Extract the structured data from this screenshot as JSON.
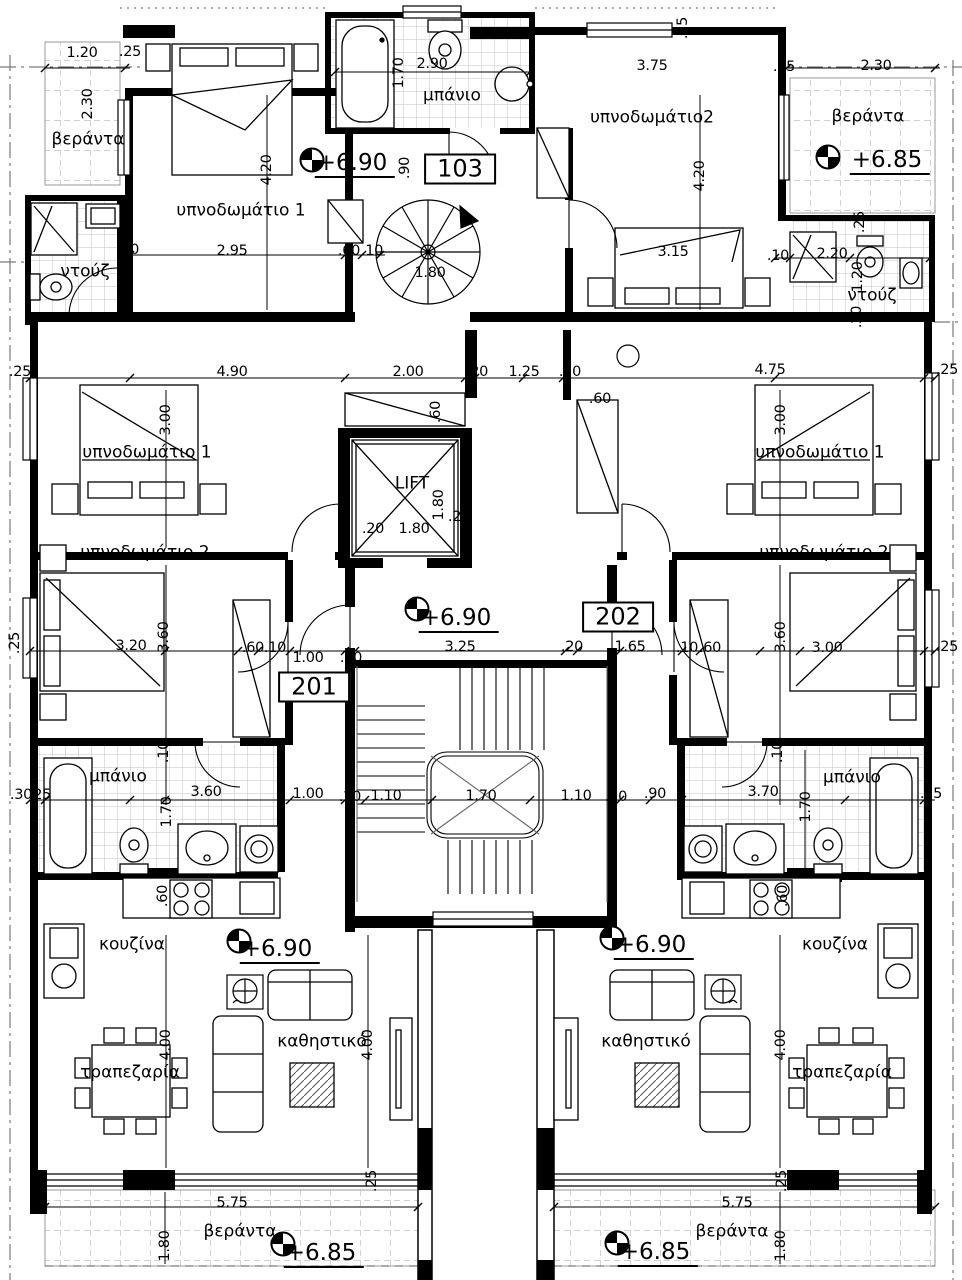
{
  "drawing": {
    "type": "architectural-floor-plan",
    "floor_levels_shown": [
      "+6.90",
      "+6.85"
    ],
    "unit_numbers_shown": [
      "103",
      "201",
      "202"
    ],
    "line_color": "#000000",
    "tile_color": "#bdbdbd"
  },
  "rooms": [
    {
      "id": "veranda-top-left",
      "text": "βεράντα",
      "x": 88,
      "y": 140
    },
    {
      "id": "bedroom1-103",
      "text": "υπνοδωμάτιο 1",
      "x": 241,
      "y": 211
    },
    {
      "id": "bath-103",
      "text": "μπάνιο",
      "x": 452,
      "y": 96
    },
    {
      "id": "bedroom2-103",
      "text": "υπνοδωμάτιο2",
      "x": 652,
      "y": 118
    },
    {
      "id": "veranda-top-right",
      "text": "βεράντα",
      "x": 868,
      "y": 117
    },
    {
      "id": "shower-left",
      "text": "ντούζ",
      "x": 85,
      "y": 272
    },
    {
      "id": "shower-right",
      "text": "ντούζ",
      "x": 872,
      "y": 296
    },
    {
      "id": "lift",
      "text": "LIFT",
      "x": 412,
      "y": 484
    },
    {
      "id": "bedroom1-201",
      "text": "υπνοδωμάτιο 1",
      "x": 147,
      "y": 453
    },
    {
      "id": "bedroom1-202",
      "text": "υπνοδωμάτιο 1",
      "x": 820,
      "y": 453
    },
    {
      "id": "bedroom2-201",
      "text": "υπνοδωμάτιο 2",
      "x": 145,
      "y": 553
    },
    {
      "id": "bedroom2-202",
      "text": "υπνοδωμάτιο 2",
      "x": 824,
      "y": 553
    },
    {
      "id": "bath-201",
      "text": "μπάνιο",
      "x": 118,
      "y": 777
    },
    {
      "id": "bath-202",
      "text": "μπάνιο",
      "x": 852,
      "y": 778
    },
    {
      "id": "kitchen-201",
      "text": "κουζίνα",
      "x": 132,
      "y": 945
    },
    {
      "id": "kitchen-202",
      "text": "κουζίνα",
      "x": 835,
      "y": 945
    },
    {
      "id": "living-201",
      "text": "καθηστικό",
      "x": 322,
      "y": 1042
    },
    {
      "id": "living-202",
      "text": "καθηστικό",
      "x": 646,
      "y": 1042
    },
    {
      "id": "dining-201",
      "text": "τραπεζαρία",
      "x": 130,
      "y": 1073
    },
    {
      "id": "dining-202",
      "text": "τραπεζαρία",
      "x": 842,
      "y": 1073
    },
    {
      "id": "veranda-bottom-left",
      "text": "βεράντα",
      "x": 240,
      "y": 1232
    },
    {
      "id": "veranda-bottom-right",
      "text": "βεράντα",
      "x": 732,
      "y": 1232
    }
  ],
  "unit_labels": [
    {
      "id": "103",
      "text": "103",
      "x": 460,
      "y": 169
    },
    {
      "id": "201",
      "text": "201",
      "x": 314,
      "y": 687
    },
    {
      "id": "202",
      "text": "202",
      "x": 618,
      "y": 617
    }
  ],
  "levels": [
    {
      "text": "+6.90",
      "x": 355,
      "y": 165,
      "mx": 312,
      "my": 160
    },
    {
      "text": "+6.85",
      "x": 890,
      "y": 162,
      "mx": 828,
      "my": 157
    },
    {
      "text": "+6.90",
      "x": 459,
      "y": 620,
      "mx": 417,
      "my": 609
    },
    {
      "text": "+6.90",
      "x": 280,
      "y": 951,
      "mx": 239,
      "my": 941
    },
    {
      "text": "+6.90",
      "x": 654,
      "y": 947,
      "mx": 612,
      "my": 938
    },
    {
      "text": "+6.85",
      "x": 324,
      "y": 1255,
      "mx": 283,
      "my": 1244
    },
    {
      "text": "+6.85",
      "x": 658,
      "y": 1254,
      "mx": 617,
      "my": 1243
    }
  ],
  "dimensions": [
    {
      "t": "1.20",
      "x": 82,
      "y": 53
    },
    {
      "t": ".25",
      "x": 130,
      "y": 52
    },
    {
      "t": "2.90",
      "x": 432,
      "y": 64
    },
    {
      "t": "3.75",
      "x": 652,
      "y": 66
    },
    {
      "t": ".25",
      "x": 683,
      "y": 28,
      "r": 1
    },
    {
      "t": "2.30",
      "x": 876,
      "y": 66
    },
    {
      "t": ".25",
      "x": 784,
      "y": 67
    },
    {
      "t": "2.30",
      "x": 88,
      "y": 104,
      "r": 1
    },
    {
      "t": "1.70",
      "x": 399,
      "y": 73,
      "r": 1
    },
    {
      "t": "4.20",
      "x": 267,
      "y": 170,
      "r": 1
    },
    {
      "t": ".90",
      "x": 405,
      "y": 168,
      "r": 1
    },
    {
      "t": "2.95",
      "x": 232,
      "y": 251
    },
    {
      "t": ".60",
      "x": 349,
      "y": 251
    },
    {
      "t": ".10",
      "x": 372,
      "y": 251
    },
    {
      "t": ".20",
      "x": 128,
      "y": 250
    },
    {
      "t": "1.80",
      "x": 430,
      "y": 273
    },
    {
      "t": "4.20",
      "x": 700,
      "y": 176,
      "r": 1
    },
    {
      "t": "3.15",
      "x": 673,
      "y": 252
    },
    {
      "t": ".10",
      "x": 778,
      "y": 256
    },
    {
      "t": "2.20",
      "x": 832,
      "y": 254
    },
    {
      "t": ".25",
      "x": 860,
      "y": 222,
      "r": 1
    },
    {
      "t": "1.20",
      "x": 858,
      "y": 277,
      "r": 1
    },
    {
      "t": ".20",
      "x": 857,
      "y": 317,
      "r": 1
    },
    {
      "t": ".25",
      "x": 20,
      "y": 372
    },
    {
      "t": "4.90",
      "x": 232,
      "y": 372
    },
    {
      "t": "2.00",
      "x": 408,
      "y": 372
    },
    {
      "t": ".20",
      "x": 477,
      "y": 372
    },
    {
      "t": "1.25",
      "x": 524,
      "y": 372
    },
    {
      "t": ".20",
      "x": 570,
      "y": 372
    },
    {
      "t": ".60",
      "x": 600,
      "y": 399
    },
    {
      "t": "4.75",
      "x": 770,
      "y": 370
    },
    {
      "t": ".25",
      "x": 947,
      "y": 370
    },
    {
      "t": ".60",
      "x": 436,
      "y": 412,
      "r": 1
    },
    {
      "t": "1.80",
      "x": 439,
      "y": 505,
      "r": 1
    },
    {
      "t": ".20",
      "x": 459,
      "y": 517
    },
    {
      "t": ".20",
      "x": 373,
      "y": 529
    },
    {
      "t": "1.80",
      "x": 414,
      "y": 529
    },
    {
      "t": "3.00",
      "x": 166,
      "y": 420,
      "r": 1
    },
    {
      "t": "3.00",
      "x": 781,
      "y": 420,
      "r": 1
    },
    {
      "t": "3.20",
      "x": 131,
      "y": 646
    },
    {
      "t": "3.60",
      "x": 164,
      "y": 637,
      "r": 1
    },
    {
      "t": ".60",
      "x": 253,
      "y": 648
    },
    {
      "t": ".10",
      "x": 275,
      "y": 648
    },
    {
      "t": "1.00",
      "x": 308,
      "y": 658
    },
    {
      "t": ".20",
      "x": 351,
      "y": 658
    },
    {
      "t": "3.25",
      "x": 460,
      "y": 647
    },
    {
      "t": ".20",
      "x": 572,
      "y": 647
    },
    {
      "t": "1.65",
      "x": 630,
      "y": 647
    },
    {
      "t": ".10",
      "x": 687,
      "y": 648
    },
    {
      "t": ".60",
      "x": 710,
      "y": 648
    },
    {
      "t": "3.60",
      "x": 781,
      "y": 637,
      "r": 1
    },
    {
      "t": "3.00",
      "x": 827,
      "y": 648
    },
    {
      "t": ".25",
      "x": 947,
      "y": 647
    },
    {
      "t": ".25",
      "x": 15,
      "y": 643,
      "r": 1
    },
    {
      "t": ".30",
      "x": 21,
      "y": 795
    },
    {
      "t": ".25",
      "x": 40,
      "y": 795
    },
    {
      "t": "3.60",
      "x": 206,
      "y": 792
    },
    {
      "t": "1.70",
      "x": 167,
      "y": 812,
      "r": 1
    },
    {
      "t": ".10",
      "x": 164,
      "y": 752,
      "r": 1
    },
    {
      "t": "1.00",
      "x": 308,
      "y": 794
    },
    {
      "t": ".20",
      "x": 350,
      "y": 797
    },
    {
      "t": "1.10",
      "x": 386,
      "y": 796
    },
    {
      "t": "1.70",
      "x": 481,
      "y": 796
    },
    {
      "t": "1.10",
      "x": 576,
      "y": 796
    },
    {
      "t": ".20",
      "x": 616,
      "y": 797
    },
    {
      "t": ".90",
      "x": 655,
      "y": 794
    },
    {
      "t": "3.70",
      "x": 763,
      "y": 792
    },
    {
      "t": "1.70",
      "x": 806,
      "y": 807,
      "r": 1
    },
    {
      "t": ".10",
      "x": 778,
      "y": 752,
      "r": 1
    },
    {
      "t": ".25",
      "x": 931,
      "y": 794
    },
    {
      "t": ".60",
      "x": 163,
      "y": 896,
      "r": 1
    },
    {
      "t": ".60",
      "x": 783,
      "y": 896,
      "r": 1
    },
    {
      "t": "4.00",
      "x": 166,
      "y": 1045,
      "r": 1
    },
    {
      "t": "4.00",
      "x": 368,
      "y": 1045,
      "r": 1
    },
    {
      "t": "4.00",
      "x": 781,
      "y": 1045,
      "r": 1
    },
    {
      "t": ".25",
      "x": 372,
      "y": 1181,
      "r": 1
    },
    {
      "t": ".25",
      "x": 782,
      "y": 1181,
      "r": 1
    },
    {
      "t": "5.75",
      "x": 232,
      "y": 1203
    },
    {
      "t": "5.75",
      "x": 737,
      "y": 1203
    },
    {
      "t": "1.80",
      "x": 165,
      "y": 1246,
      "r": 1
    },
    {
      "t": "1.80",
      "x": 781,
      "y": 1246,
      "r": 1
    }
  ]
}
